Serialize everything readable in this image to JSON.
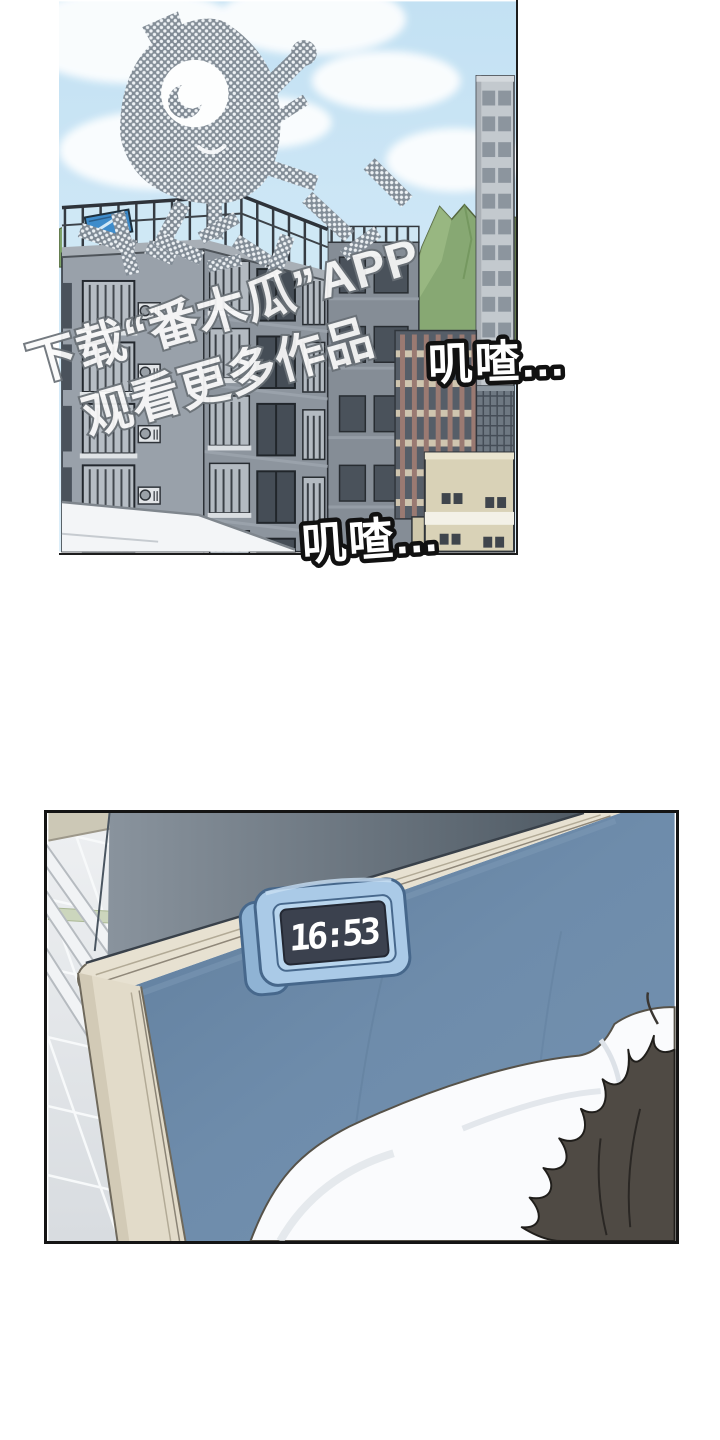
{
  "page": {
    "title": "comic-page",
    "panel_count": 2
  },
  "watermark": {
    "line1": "下载“番木瓜”APP",
    "line2": "观看更多作品",
    "mascot_icon": "papaya-mascot"
  },
  "panel_city": {
    "sfx_top": "叽喳...",
    "sfx_bottom": "叽喳..."
  },
  "panel_bedroom": {
    "clock_time": "16:53"
  },
  "colors": {
    "sky": "#c8e4f4",
    "building_gray": "#949ca5",
    "mountain_green": "#87a873",
    "solar_panel_blue": "#3e8ccb",
    "wall_blue_gray": "#77828e",
    "headboard_blue": "#6e8cab",
    "rail_cream": "#e7e1d1",
    "clock_body_blue": "#aacae7",
    "clock_display": "#3b414e",
    "pillow_white": "#fafbfd",
    "hair_brown": "#4f4a44",
    "sfx_fill": "#ffffff",
    "sfx_stroke": "#111111",
    "watermark_fill": "#fafafa",
    "watermark_stroke": "#6a7177"
  }
}
